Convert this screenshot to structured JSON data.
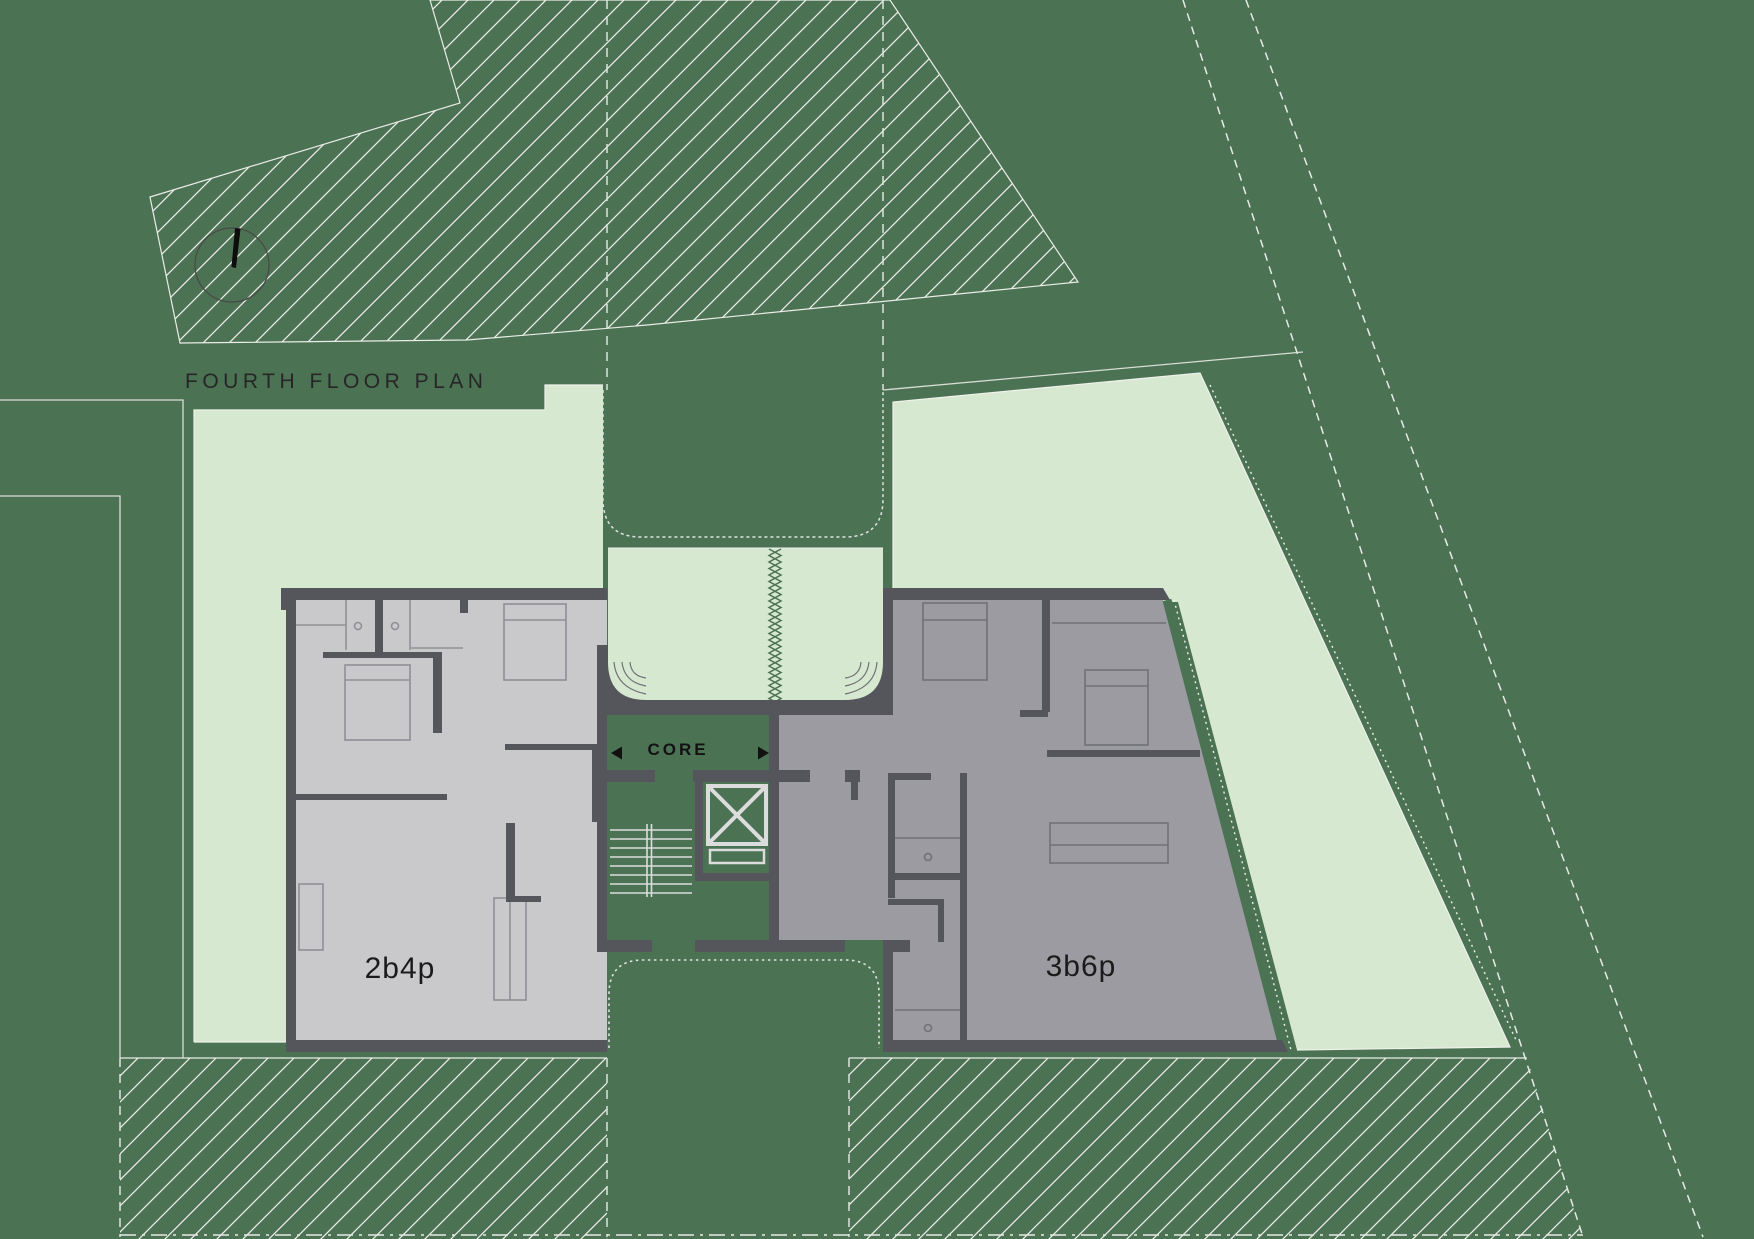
{
  "title": "FOURTH FLOOR PLAN",
  "units": {
    "left": {
      "label": "2b4p"
    },
    "right": {
      "label": "3b6p"
    }
  },
  "core": {
    "label": "CORE"
  },
  "icons": {
    "north_arrow": "north-arrow-icon",
    "core_arrow_left": "arrow-left-icon",
    "core_arrow_right": "arrow-right-icon",
    "elevator": "elevator-icon",
    "stairs": "stairs-icon"
  },
  "colors": {
    "background": "#4c7254",
    "hatch_line": "#e9ece7",
    "terrace_green": "#d7e8d0",
    "unit_left_fill": "#c9c9cc",
    "unit_right_fill": "#9b9ba1",
    "wall": "#54565b",
    "boundary_line": "#dfe3de",
    "label_text": "#1b1b1b"
  }
}
